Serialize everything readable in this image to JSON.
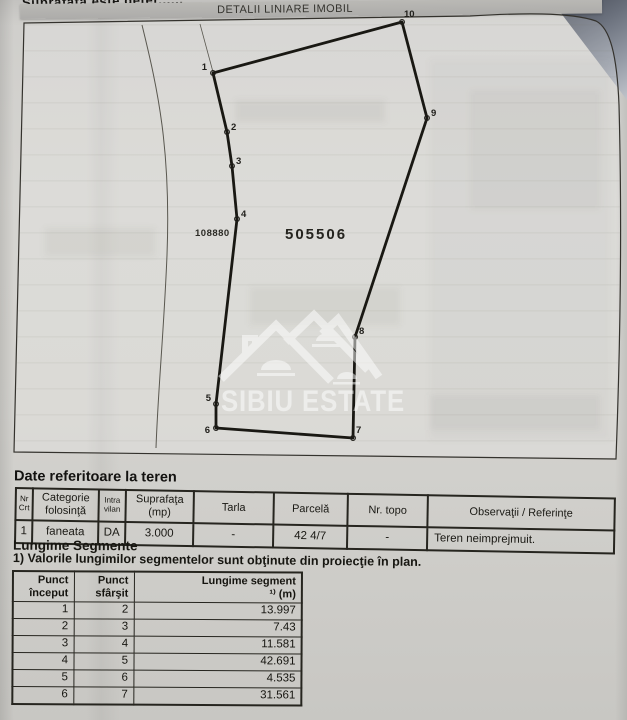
{
  "document": {
    "top_partial_text": "Suprafaţa este deter......",
    "plan_title": "DETALII LINIARE IMOBIL"
  },
  "plan": {
    "parcel_number_left": "108880",
    "parcel_number_main": "505506",
    "watermark_text": "SIBIU ESTATE",
    "vertices": [
      {
        "label": "1",
        "x": 213,
        "y": 73,
        "lx": 207,
        "ly": 70,
        "anchor": "end"
      },
      {
        "label": "2",
        "x": 227,
        "y": 132,
        "lx": 231,
        "ly": 130,
        "anchor": "start"
      },
      {
        "label": "3",
        "x": 232,
        "y": 166,
        "lx": 236,
        "ly": 164,
        "anchor": "start"
      },
      {
        "label": "4",
        "x": 237,
        "y": 219,
        "lx": 241,
        "ly": 217,
        "anchor": "start"
      },
      {
        "label": "5",
        "x": 216,
        "y": 404,
        "lx": 211,
        "ly": 401,
        "anchor": "end"
      },
      {
        "label": "6",
        "x": 216,
        "y": 428,
        "lx": 210,
        "ly": 433,
        "anchor": "end"
      },
      {
        "label": "7",
        "x": 353,
        "y": 438,
        "lx": 356,
        "ly": 433,
        "anchor": "start"
      },
      {
        "label": "8",
        "x": 355,
        "y": 337,
        "lx": 359,
        "ly": 334,
        "anchor": "start"
      },
      {
        "label": "9",
        "x": 427,
        "y": 118,
        "lx": 431,
        "ly": 116,
        "anchor": "start"
      },
      {
        "label": "10",
        "x": 402,
        "y": 22,
        "lx": 404,
        "ly": 17,
        "anchor": "start"
      }
    ]
  },
  "land_table": {
    "title": "Date referitoare la teren",
    "headers": [
      "Nr\nCrt",
      "Categorie\nfolosinţă",
      "Intra\nvilan",
      "Suprafaţa\n(mp)",
      "Tarla",
      "Parcelă",
      "Nr. topo",
      "Observaţii / Referinţe"
    ],
    "row": [
      "1",
      "faneata",
      "DA",
      "3.000",
      "-",
      "42 4/7",
      "-",
      "Teren neimprejmuit."
    ]
  },
  "segments": {
    "title": "Lungime Segmente",
    "note": "1) Valorile lungimilor segmentelor sunt obţinute din proiecţie în plan.",
    "headers": [
      "Punct\nînceput",
      "Punct\nsfârşit",
      "Lungime segment\n¹⁾ (m)"
    ],
    "rows": [
      [
        "1",
        "2",
        "13.997"
      ],
      [
        "2",
        "3",
        "7.43"
      ],
      [
        "3",
        "4",
        "11.581"
      ],
      [
        "4",
        "5",
        "42.691"
      ],
      [
        "5",
        "6",
        "4.535"
      ],
      [
        "6",
        "7",
        "31.561"
      ]
    ]
  }
}
